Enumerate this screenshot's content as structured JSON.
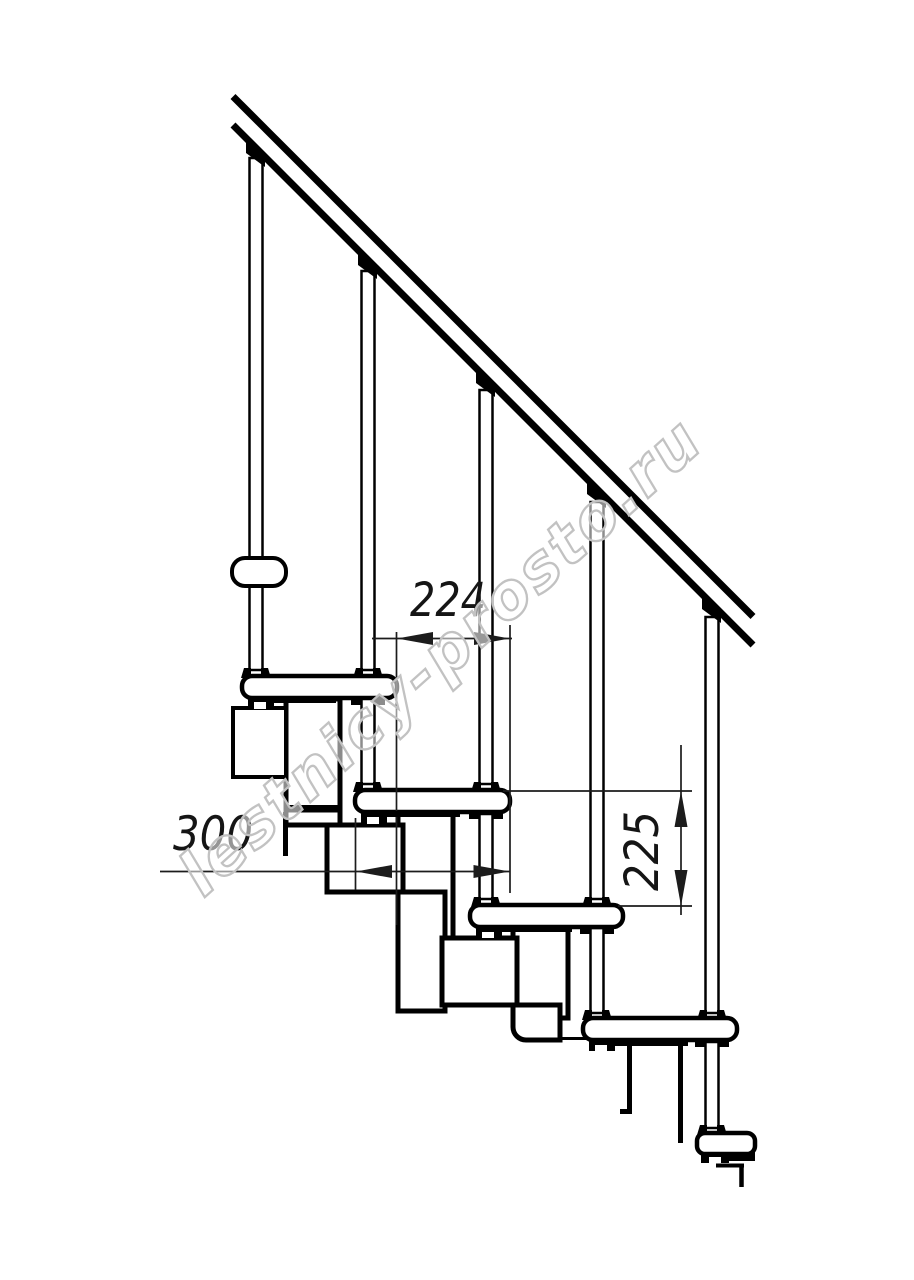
{
  "title": "Staircase side-view technical drawing",
  "watermark": {
    "text": "lestnicy-prosto.ru",
    "stroke_color": "#c2c2c2",
    "fill_color": "#ffffff",
    "fill_opacity": 0.55
  },
  "dimensions": {
    "going": {
      "value": "224"
    },
    "tread_depth": {
      "value": "300"
    },
    "rise": {
      "value": "225"
    }
  },
  "drawing": {
    "colors": {
      "line": "#000000",
      "dim_line": "#1c1c1c",
      "fill": "#ffffff"
    },
    "geometry": {
      "structure_rects": [
        {
          "x": 286,
          "y": 699,
          "w": 54,
          "h": 126,
          "sw": 5
        },
        {
          "x": 233,
          "y": 708,
          "w": 53,
          "h": 69,
          "sw": 4
        },
        {
          "x": 398,
          "y": 813,
          "w": 55,
          "h": 125,
          "sw": 5
        },
        {
          "x": 327,
          "y": 825,
          "w": 76,
          "h": 67,
          "sw": 5
        },
        {
          "x": 398,
          "y": 892,
          "w": 47,
          "h": 119,
          "sw": 5
        },
        {
          "x": 513,
          "y": 927,
          "w": 55,
          "h": 91,
          "sw": 5
        },
        {
          "x": 442,
          "y": 938,
          "w": 75,
          "h": 67,
          "sw": 5
        }
      ],
      "structure_paths": [
        {
          "d": "M 513 1005 L 560 1005 L 560 1040 L 526 1040 A 13 13 0 0 1 513 1027 Z",
          "sw": 5
        }
      ],
      "structure_lines": [
        {
          "x1": 285.5,
          "y1": 812,
          "x2": 285.5,
          "y2": 856,
          "w": 5
        },
        {
          "x1": 629.5,
          "y1": 1042,
          "x2": 629.5,
          "y2": 1113,
          "w": 5
        },
        {
          "x1": 680.5,
          "y1": 1042,
          "x2": 680.5,
          "y2": 1143,
          "w": 5
        },
        {
          "x1": 558,
          "y1": 1038.5,
          "x2": 586,
          "y2": 1038.5,
          "w": 3
        },
        {
          "x1": 716,
          "y1": 1165.5,
          "x2": 744,
          "y2": 1165.5,
          "w": 4
        },
        {
          "x1": 741.5,
          "y1": 1164,
          "x2": 741.5,
          "y2": 1187,
          "w": 4.5
        }
      ],
      "solid_bars": [
        {
          "x": 284,
          "y": 805,
          "w": 55,
          "h": 7.5
        },
        {
          "x": 620,
          "y": 1109,
          "w": 12,
          "h": 5
        }
      ],
      "baluster_tubes": [
        {
          "x": 249.5,
          "y": 158,
          "w": 13,
          "h": 512
        },
        {
          "x": 361.5,
          "y": 271,
          "w": 13,
          "h": 399
        },
        {
          "x": 361.5,
          "y": 698,
          "w": 13,
          "h": 86
        },
        {
          "x": 479.5,
          "y": 390,
          "w": 13,
          "h": 394
        },
        {
          "x": 479.5,
          "y": 814,
          "w": 13,
          "h": 85
        },
        {
          "x": 590.5,
          "y": 502,
          "w": 13,
          "h": 397
        },
        {
          "x": 590.5,
          "y": 928,
          "w": 13,
          "h": 85
        },
        {
          "x": 705.5,
          "y": 617,
          "w": 13,
          "h": 396
        },
        {
          "x": 705.5,
          "y": 1042,
          "w": 13,
          "h": 86
        }
      ],
      "treads": [
        {
          "x": 242,
          "y": 676,
          "w": 155,
          "h": 22,
          "rx": 10
        },
        {
          "x": 355,
          "y": 790,
          "w": 155,
          "h": 22,
          "rx": 10
        },
        {
          "x": 470,
          "y": 905,
          "w": 153,
          "h": 22,
          "rx": 10
        },
        {
          "x": 583,
          "y": 1018,
          "w": 154,
          "h": 22,
          "rx": 10
        },
        {
          "x": 697,
          "y": 1133,
          "w": 58,
          "h": 21,
          "rx": 8
        }
      ],
      "rail_bracket": {
        "x": 232,
        "y": 558,
        "w": 54,
        "h": 28,
        "rx": 13,
        "sw": 4
      },
      "dim_lines": [
        {
          "x1": 396.5,
          "y1": 632,
          "x2": 396.5,
          "y2": 925
        },
        {
          "x1": 510,
          "y1": 625,
          "x2": 510,
          "y2": 893
        },
        {
          "x1": 355.5,
          "y1": 818,
          "x2": 355.5,
          "y2": 890
        },
        {
          "x1": 503,
          "y1": 791,
          "x2": 692,
          "y2": 791
        },
        {
          "x1": 618,
          "y1": 906,
          "x2": 692,
          "y2": 906
        },
        {
          "x1": 372,
          "y1": 638.5,
          "x2": 512,
          "y2": 638.5
        },
        {
          "x1": 160,
          "y1": 871.5,
          "x2": 510,
          "y2": 871.5
        },
        {
          "x1": 681,
          "y1": 745,
          "x2": 681,
          "y2": 915
        }
      ],
      "dim_arrows": [
        [
          [
            397,
            638.5
          ],
          [
            433,
            632
          ],
          [
            433,
            645
          ]
        ],
        [
          [
            510,
            638.5
          ],
          [
            474,
            632
          ],
          [
            474,
            645
          ]
        ],
        [
          [
            356,
            871.5
          ],
          [
            392,
            865
          ],
          [
            392,
            878
          ]
        ],
        [
          [
            509.5,
            871.5
          ],
          [
            473.5,
            865
          ],
          [
            473.5,
            878
          ]
        ],
        [
          [
            681,
            791
          ],
          [
            674.5,
            827
          ],
          [
            687.5,
            827
          ]
        ],
        [
          [
            681,
            906
          ],
          [
            674.5,
            870
          ],
          [
            687.5,
            870
          ]
        ]
      ],
      "fastener_blocks": [
        {
          "x": 248,
          "y": 697,
          "w": 26,
          "h": 11
        },
        {
          "x": 272,
          "y": 697,
          "w": 64,
          "h": 6
        },
        {
          "x": 351,
          "y": 697,
          "w": 10,
          "h": 8
        },
        {
          "x": 375,
          "y": 697,
          "w": 10,
          "h": 8
        },
        {
          "x": 361,
          "y": 811,
          "w": 26,
          "h": 13
        },
        {
          "x": 387,
          "y": 811,
          "w": 73,
          "h": 6
        },
        {
          "x": 469,
          "y": 811,
          "w": 10,
          "h": 8
        },
        {
          "x": 493,
          "y": 811,
          "w": 10,
          "h": 8
        },
        {
          "x": 476,
          "y": 926,
          "w": 26,
          "h": 12
        },
        {
          "x": 502,
          "y": 926,
          "w": 70,
          "h": 6
        },
        {
          "x": 580,
          "y": 926,
          "w": 10,
          "h": 8
        },
        {
          "x": 604,
          "y": 926,
          "w": 10,
          "h": 8
        },
        {
          "x": 589,
          "y": 1039,
          "w": 26,
          "h": 12
        },
        {
          "x": 615,
          "y": 1039,
          "w": 73,
          "h": 7
        },
        {
          "x": 695,
          "y": 1039,
          "w": 10,
          "h": 8
        },
        {
          "x": 719,
          "y": 1039,
          "w": 10,
          "h": 8
        },
        {
          "x": 701,
          "y": 1152,
          "w": 28,
          "h": 11
        },
        {
          "x": 727,
          "y": 1152,
          "w": 28,
          "h": 9
        }
      ],
      "fastener_notches": [
        {
          "x": 254,
          "y": 702,
          "w": 12,
          "h": 7
        },
        {
          "x": 367,
          "y": 817,
          "w": 12,
          "h": 7
        },
        {
          "x": 482,
          "y": 932,
          "w": 12,
          "h": 6
        },
        {
          "x": 595,
          "y": 1045,
          "w": 12,
          "h": 6
        },
        {
          "x": 709,
          "y": 1157,
          "w": 12,
          "h": 6
        }
      ],
      "collars": [
        {
          "cx": 256,
          "y": 676
        },
        {
          "cx": 368,
          "y": 676
        },
        {
          "cx": 368,
          "y": 790
        },
        {
          "cx": 486,
          "y": 790
        },
        {
          "cx": 486,
          "y": 905
        },
        {
          "cx": 597,
          "y": 905
        },
        {
          "cx": 597,
          "y": 1018
        },
        {
          "cx": 712,
          "y": 1018
        },
        {
          "cx": 712,
          "y": 1133
        }
      ],
      "handrail_lines": [
        {
          "x1": 233,
          "y1": 96.5,
          "x2": 753,
          "y2": 616.5,
          "w": 7
        },
        {
          "x1": 233,
          "y1": 125,
          "x2": 753,
          "y2": 645,
          "w": 7
        }
      ],
      "rail_wedges": [
        [
          [
            246,
            141.5
          ],
          [
            265,
            160.5
          ],
          [
            265,
            167
          ],
          [
            246,
            153
          ]
        ],
        [
          [
            358,
            253.5
          ],
          [
            377,
            272.5
          ],
          [
            377,
            279
          ],
          [
            358,
            265
          ]
        ],
        [
          [
            476,
            371.5
          ],
          [
            495,
            390.5
          ],
          [
            495,
            397
          ],
          [
            476,
            383
          ]
        ],
        [
          [
            587,
            482.5
          ],
          [
            606,
            501.5
          ],
          [
            606,
            508
          ],
          [
            587,
            494
          ]
        ],
        [
          [
            702,
            597.5
          ],
          [
            721,
            616.5
          ],
          [
            721,
            623
          ],
          [
            702,
            609
          ]
        ]
      ]
    }
  }
}
